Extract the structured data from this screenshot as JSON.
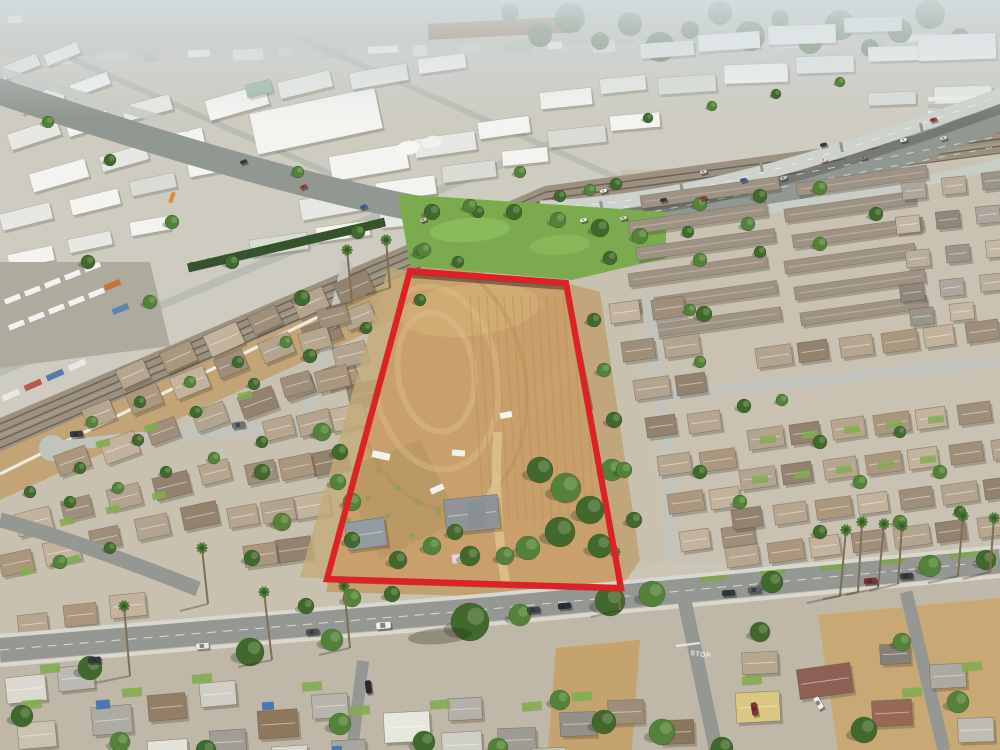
{
  "scene": {
    "label": "aerial-drone-photo-of-red-outlined-vacant-parcel"
  },
  "palette": {
    "haze": "#ccd6dc",
    "base": "#c9c3b5",
    "industrial_ground": "#cdcac0",
    "roof_white": "#f3f4f1",
    "roof_light": "#e6e8e3",
    "roof_gray": "#d8dbd5",
    "freeway_deck": "#ccd1cb",
    "freeway_asphalt": "#8d948e",
    "rail_bed": "#988c7d",
    "rail_dirt": "#c0a173",
    "wall_white": "#edeadf",
    "park_grass": "#76a848",
    "lawn": "#7fa94e",
    "tree_light": "#4e7d33",
    "tree_dark": "#3a6326",
    "street": "#90938f",
    "street_light": "#bfc1bb",
    "sidewalk": "#d8d7cf",
    "dirt": "#c79d66",
    "dirt_light": "#dcc08a",
    "dirt_dark": "#b1905e",
    "boundary_red": "#dc1a1e",
    "boundary_red_dark": "#8f1012",
    "residential_ground_left": "#c6bfae",
    "residential_ground_right": "#c7c0b0",
    "bottom_ground": "#bdb5a5",
    "townhome_roof": "#9b8e80"
  },
  "parcel": {
    "outline_points": "410,271 566,283 621,588 327,579",
    "outline_color": "#dc1a1e",
    "dirt_color": "#c79d66"
  },
  "road_markings": {
    "stop_label": "STOP"
  }
}
